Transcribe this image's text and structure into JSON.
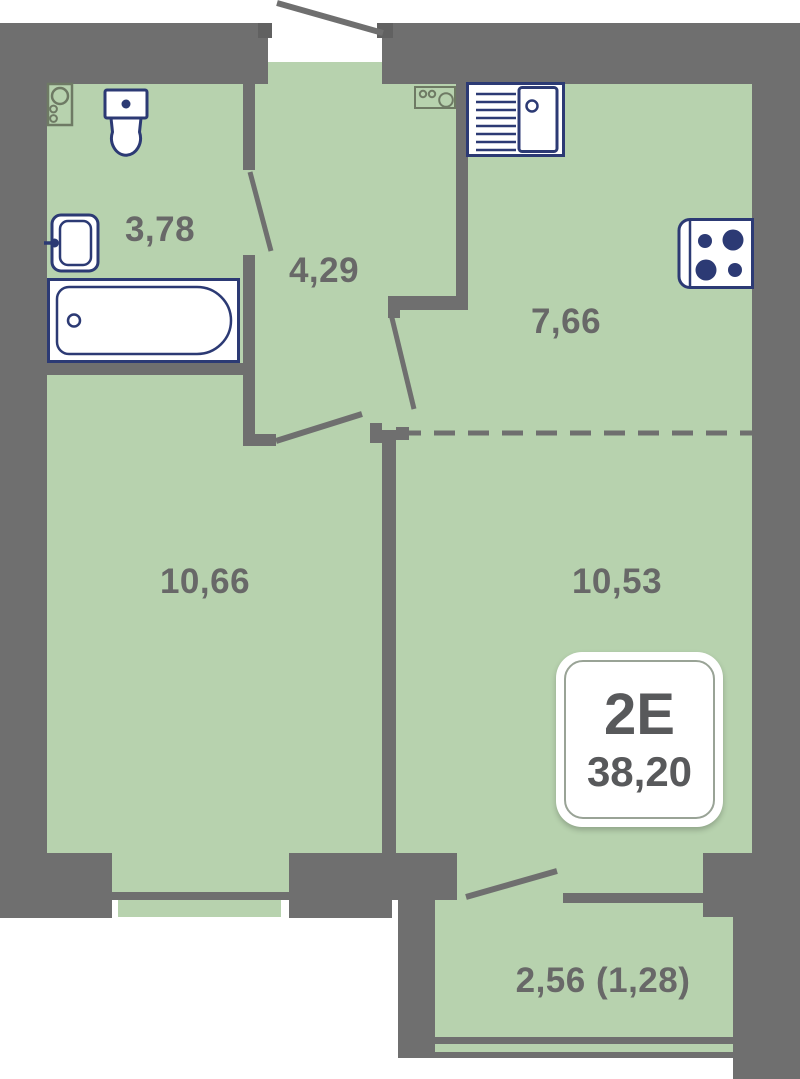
{
  "plan": {
    "badge": {
      "type": "2E",
      "area": "38,20"
    },
    "rooms": [
      {
        "id": "bathroom",
        "area": "3,78"
      },
      {
        "id": "hallway",
        "area": "4,29"
      },
      {
        "id": "kitchen",
        "area": "7,66"
      },
      {
        "id": "room-left",
        "area": "10,66"
      },
      {
        "id": "room-right",
        "area": "10,53"
      },
      {
        "id": "balcony",
        "area": "2,56 (1,28)"
      }
    ],
    "colors": {
      "floor": "#b7d2ae",
      "wall": "#6f6f6f",
      "fixture_outline": "#2c3a74",
      "appliance_outline": "#6e7a64",
      "label_text": "#686868",
      "badge_text": "#58595b"
    }
  }
}
